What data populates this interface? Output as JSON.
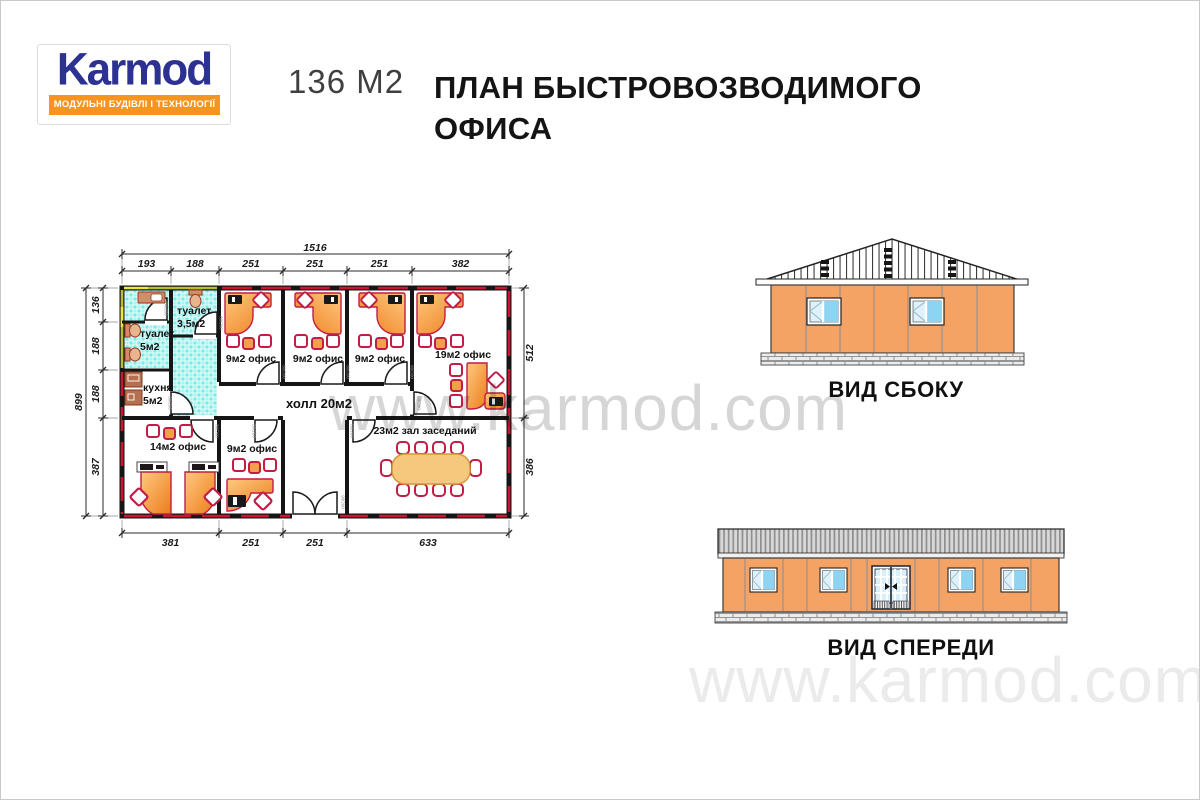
{
  "logo": {
    "brand": "Karmod",
    "tagline": "МОДУЛЬНІ БУДІВЛІ І ТЕХНОЛОГІЇ"
  },
  "header": {
    "area_label": "136 М2",
    "title_line1": "ПЛАН БЫСТРОВОЗВОДИМОГО",
    "title_line2": "ОФИСА"
  },
  "watermark": {
    "text": "www.karmod.com"
  },
  "plan": {
    "rooms": {
      "toilet_small_1": "туалет",
      "toilet_small_2": "3,5м2",
      "toilet_big_1": "туалет",
      "toilet_big_2": "5м2",
      "kitchen_1": "кухня",
      "kitchen_2": "5м2",
      "office9_a": "9м2 офис",
      "office9_b": "9м2 офис",
      "office9_c": "9м2 офис",
      "office19": "19м2 офис",
      "hall": "холл 20м2",
      "office14": "14м2 офис",
      "office9_d": "9м2 офис",
      "meeting": "23м2 зал заседаний"
    },
    "dims": {
      "top_total": "1516",
      "top_segments": [
        "193",
        "188",
        "251",
        "251",
        "251",
        "382"
      ],
      "left_total": "899",
      "left_segments": [
        "136",
        "188",
        "188",
        "387"
      ],
      "right_segments": [
        "512",
        "386"
      ],
      "bottom_segments": [
        "381",
        "251",
        "251",
        "633"
      ]
    },
    "door_tag": "80/200",
    "entrance_door_tag": "90/200"
  },
  "elevations": {
    "side_label": "ВИД СБОКУ",
    "front_label": "ВИД СПЕРЕДИ"
  },
  "colors": {
    "logo_blue": "#2c3192",
    "logo_orange": "#f7941e",
    "wall_red": "#ce1231",
    "wall_olive": "#b8bf2e",
    "tile_cyan": "#7de9e9",
    "desk_orange": "#ee7f1f",
    "chair_crimson": "#c21d45",
    "facade_orange": "#f4a365",
    "glass_blue": "#9fdcf5"
  }
}
